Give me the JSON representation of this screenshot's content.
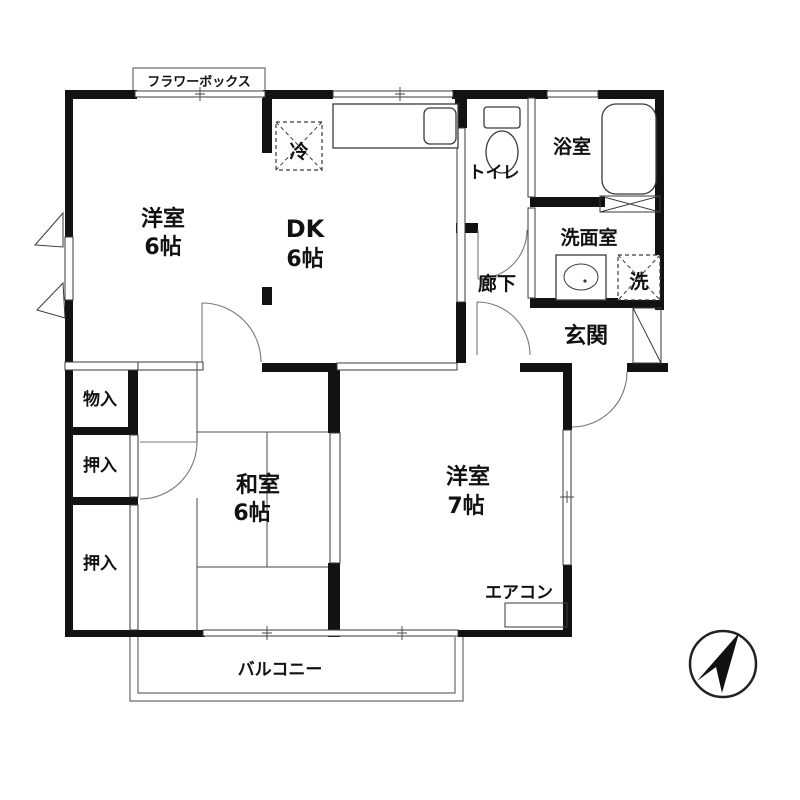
{
  "floor_plan": {
    "labels": {
      "flower_box": "フラワーボックス",
      "room_west1_name": "洋室",
      "room_west1_size": "6帖",
      "room_dk_name": "DK",
      "room_dk_size": "6帖",
      "room_japanese_name": "和室",
      "room_japanese_size": "6帖",
      "room_west2_name": "洋室",
      "room_west2_size": "7帖",
      "toilet": "トイレ",
      "bathroom": "浴室",
      "washroom": "洗面室",
      "washer": "洗",
      "refrigerator": "冷",
      "hallway": "廊下",
      "entrance": "玄関",
      "storage": "物入",
      "closet_upper": "押入",
      "closet_lower": "押入",
      "air_conditioner": "エアコン",
      "balcony": "バルコニー"
    },
    "compass": {
      "direction": "north-up-right"
    },
    "colors": {
      "background": "#ffffff",
      "wall": "#121212",
      "thin_line": "#4a4a4a"
    }
  }
}
